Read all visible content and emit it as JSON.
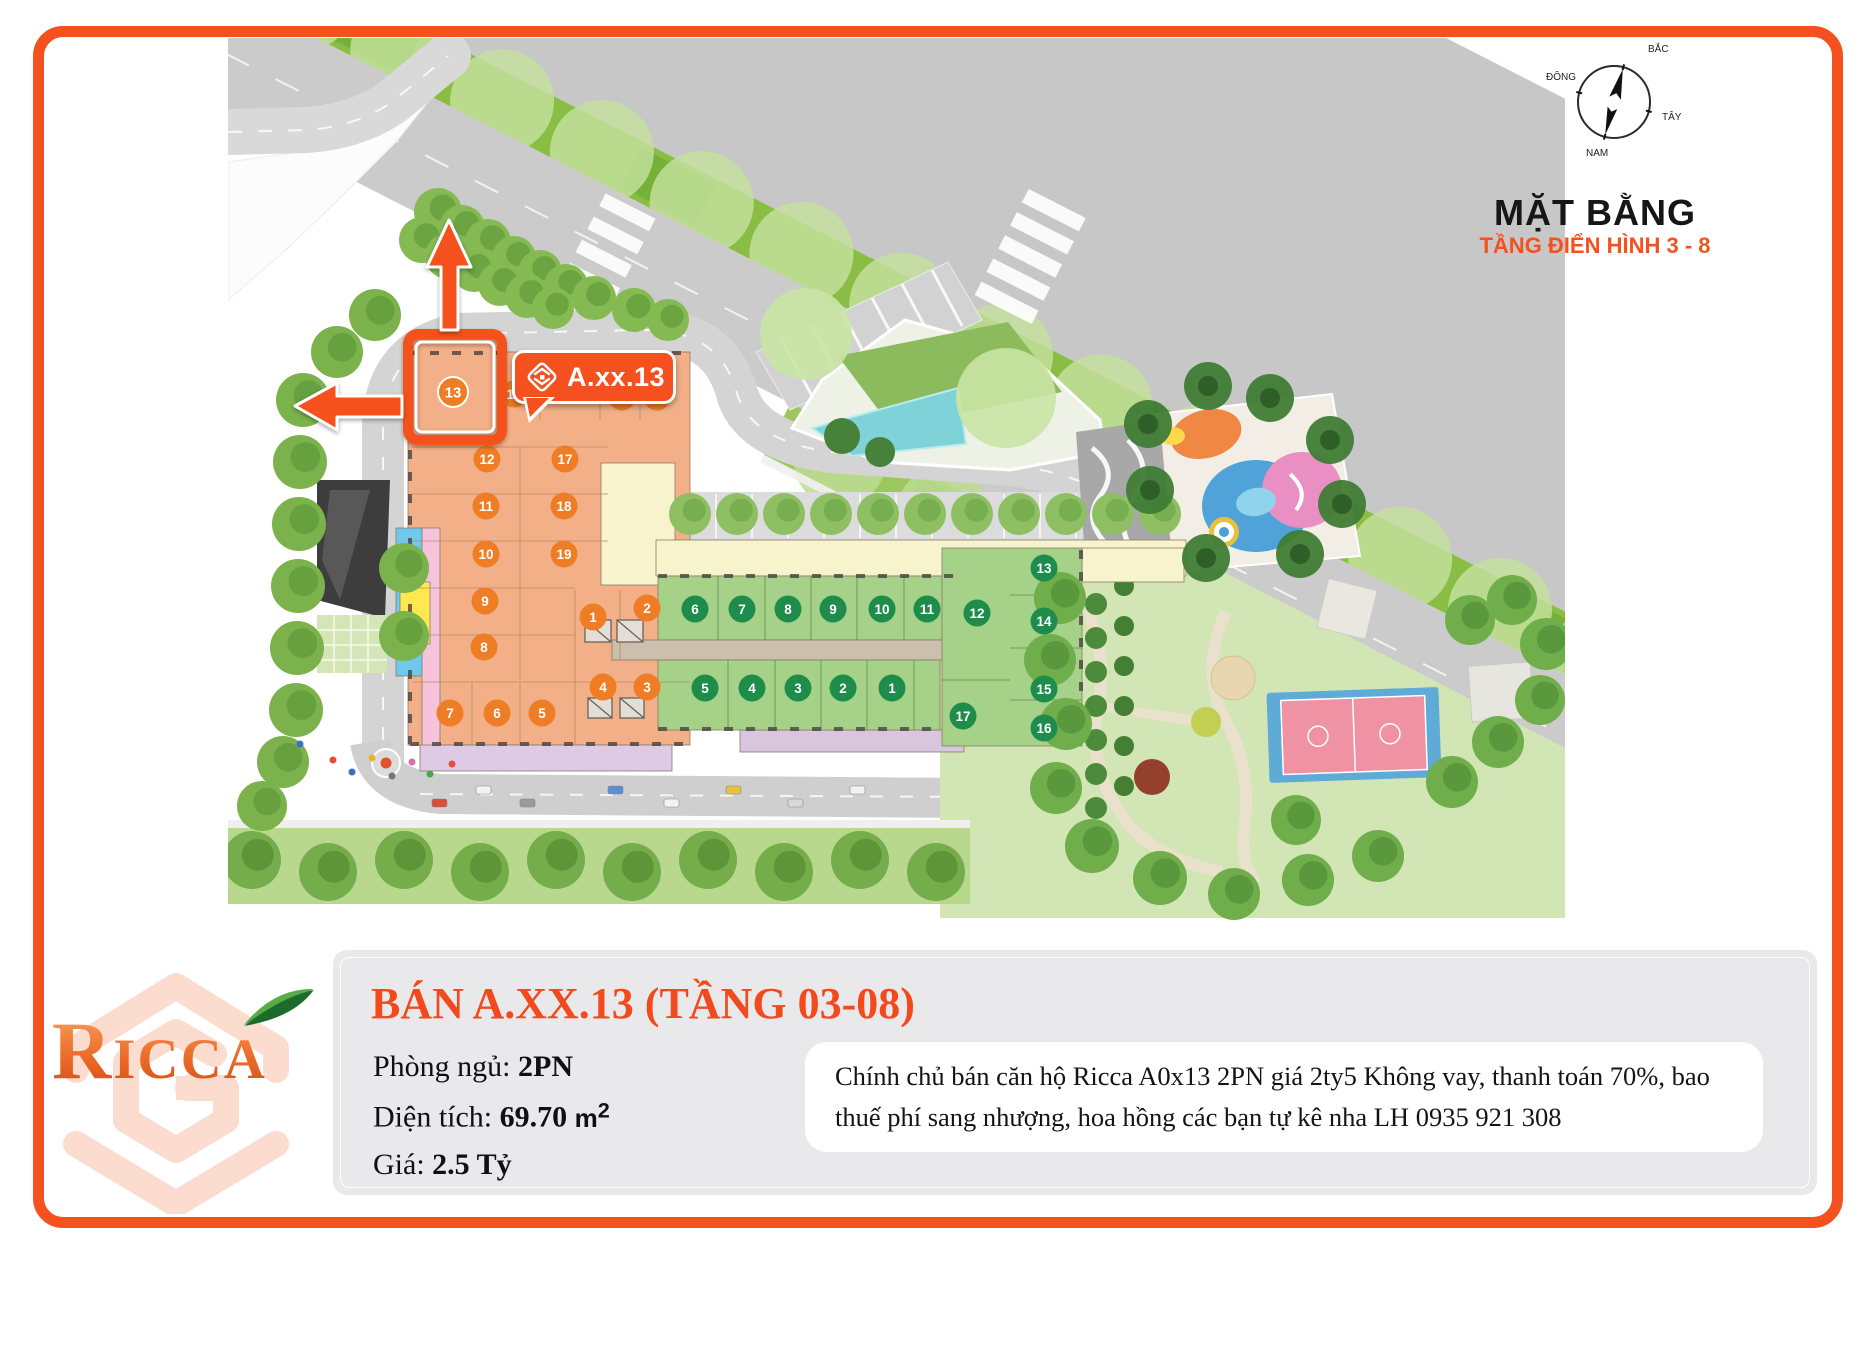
{
  "page": {
    "border_color": "#f4511e",
    "background": "#ffffff"
  },
  "site_plan": {
    "title": "MẶT BẰNG",
    "subtitle": "TẦNG ĐIỂN HÌNH 3 - 8",
    "callout_label": "A.xx.13",
    "highlighted_unit": "13",
    "compass": {
      "north": "BẮC",
      "east": "ĐÔNG",
      "west": "TÂY",
      "south": "NAM"
    },
    "badge_colors": {
      "orange": "#ee7d26",
      "green": "#1e8c4a"
    },
    "orange_units": [
      {
        "n": "13",
        "x": 453,
        "y": 392,
        "hl": true
      },
      {
        "n": "14",
        "x": 514,
        "y": 394
      },
      {
        "n": "15",
        "x": 622,
        "y": 397
      },
      {
        "n": "16",
        "x": 657,
        "y": 397
      },
      {
        "n": "12",
        "x": 487,
        "y": 459
      },
      {
        "n": "17",
        "x": 565,
        "y": 459
      },
      {
        "n": "11",
        "x": 486,
        "y": 506
      },
      {
        "n": "18",
        "x": 564,
        "y": 506
      },
      {
        "n": "10",
        "x": 486,
        "y": 554
      },
      {
        "n": "19",
        "x": 564,
        "y": 554
      },
      {
        "n": "9",
        "x": 485,
        "y": 601
      },
      {
        "n": "8",
        "x": 484,
        "y": 647
      },
      {
        "n": "1",
        "x": 593,
        "y": 617
      },
      {
        "n": "2",
        "x": 647,
        "y": 608
      },
      {
        "n": "7",
        "x": 450,
        "y": 713
      },
      {
        "n": "6",
        "x": 497,
        "y": 713
      },
      {
        "n": "5",
        "x": 542,
        "y": 713
      },
      {
        "n": "4",
        "x": 603,
        "y": 687
      },
      {
        "n": "3",
        "x": 647,
        "y": 687
      }
    ],
    "green_units": [
      {
        "n": "6",
        "x": 695,
        "y": 609
      },
      {
        "n": "7",
        "x": 742,
        "y": 609
      },
      {
        "n": "8",
        "x": 788,
        "y": 609
      },
      {
        "n": "9",
        "x": 833,
        "y": 609
      },
      {
        "n": "10",
        "x": 882,
        "y": 609
      },
      {
        "n": "11",
        "x": 927,
        "y": 609
      },
      {
        "n": "12",
        "x": 977,
        "y": 613
      },
      {
        "n": "13",
        "x": 1044,
        "y": 568
      },
      {
        "n": "14",
        "x": 1044,
        "y": 621
      },
      {
        "n": "15",
        "x": 1044,
        "y": 689
      },
      {
        "n": "16",
        "x": 1044,
        "y": 728
      },
      {
        "n": "17",
        "x": 963,
        "y": 716
      },
      {
        "n": "5",
        "x": 705,
        "y": 688
      },
      {
        "n": "4",
        "x": 752,
        "y": 688
      },
      {
        "n": "3",
        "x": 798,
        "y": 688
      },
      {
        "n": "2",
        "x": 843,
        "y": 688
      },
      {
        "n": "1",
        "x": 892,
        "y": 688
      }
    ]
  },
  "brand": {
    "name": "Ricca"
  },
  "listing": {
    "heading": "BÁN A.XX.13 (TẦNG 03-08)",
    "bedrooms_label": "Phòng ngủ:",
    "bedrooms_value": "2PN",
    "area_label": "Diện tích:",
    "area_value": "69.70",
    "area_unit_base": "m",
    "area_unit_sup": "2",
    "price_label": "Giá:",
    "price_value": "2.5 Tỷ",
    "description": "Chính chủ bán căn hộ Ricca A0x13 2PN giá 2ty5 Không vay, thanh toán 70%, bao thuế phí sang nhượng, hoa hồng các bạn tự kê nha LH 0935 921 308"
  }
}
